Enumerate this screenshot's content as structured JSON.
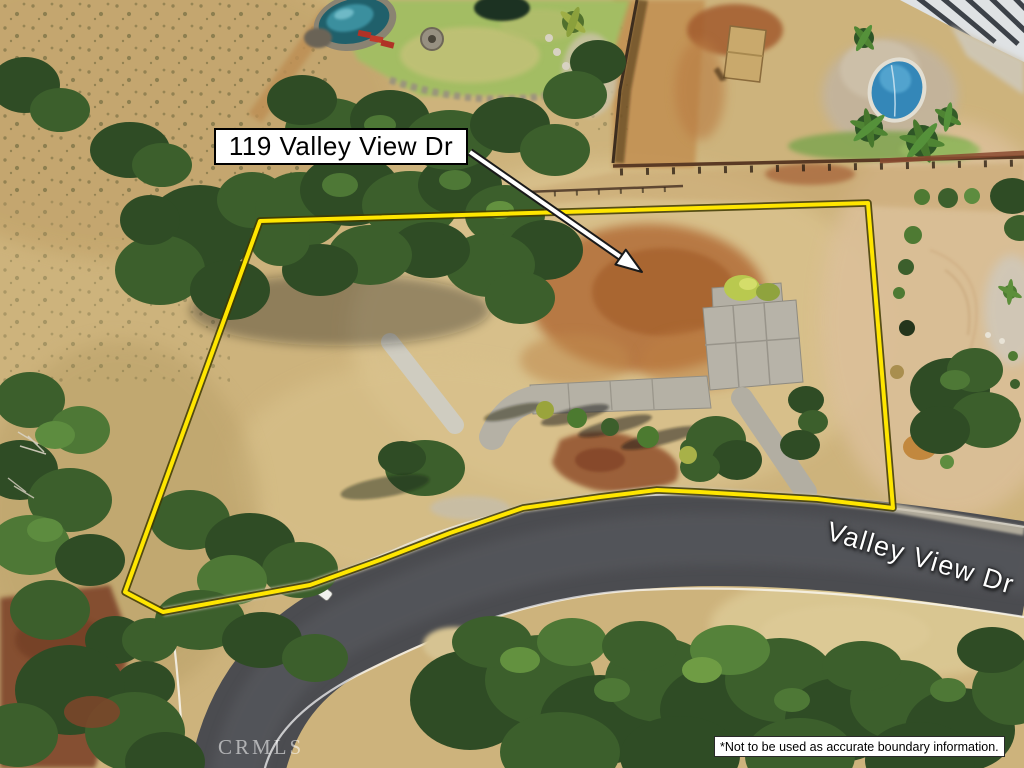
{
  "annotation": {
    "address_label": "119 Valley View Dr"
  },
  "road": {
    "street_label": "Valley View Dr"
  },
  "footer": {
    "disclaimer": "*Not to be used as accurate boundary information.",
    "watermark": "CRMLS"
  },
  "colors": {
    "boundary_line": "#ffe600",
    "road_asphalt": "#4b4c50",
    "dry_grass": "#cdb37c",
    "red_dirt": "#b26d38",
    "tree_green": "#3a5a2a",
    "annotation_bg": "#ffffff",
    "annotation_text": "#000000",
    "street_label_text": "#ffffff"
  }
}
